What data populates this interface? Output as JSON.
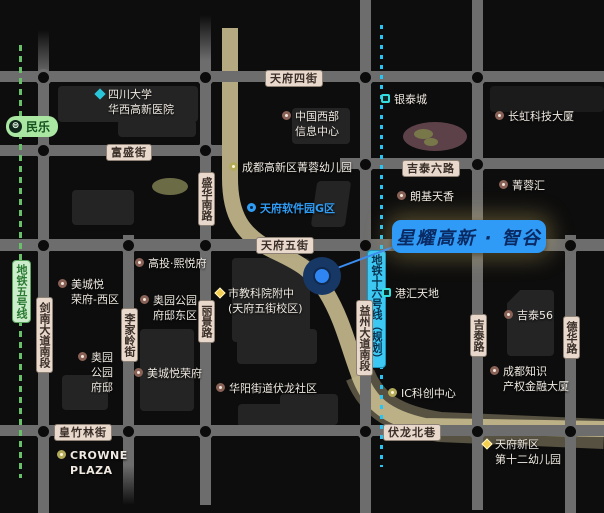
{
  "callout": {
    "text": "星耀高新 · 智谷"
  },
  "marker": {
    "name": "project-location"
  },
  "metro": {
    "line5": {
      "label": "地铁五号线",
      "station": "民乐",
      "color": "#69c06b"
    },
    "line16": {
      "label": "地铁十六号线（规划）",
      "color": "#29c4f2"
    }
  },
  "roads": {
    "h": [
      "天府四街",
      "富盛街",
      "吉泰六路",
      "天府五街",
      "皇竹林街",
      "伏龙北巷"
    ],
    "v": [
      "剑南大道南段",
      "李家岭街",
      "盛华南路",
      "丽景路",
      "益州大道南段",
      "吉泰路",
      "德华路"
    ]
  },
  "pois": [
    {
      "text": "四川大学\n华西高新医院",
      "icon": "hospital"
    },
    {
      "text": "中国西部\n信息中心",
      "icon": "building"
    },
    {
      "text": "成都高新区菁蓉幼儿园",
      "icon": "kindergarten"
    },
    {
      "text": "银泰城",
      "icon": "mall"
    },
    {
      "text": "长虹科技大厦",
      "icon": "building"
    },
    {
      "text": "菁蓉汇",
      "icon": "building"
    },
    {
      "text": "朗基天香",
      "icon": "building"
    },
    {
      "text": "天府软件园G区",
      "icon": "tech-park"
    },
    {
      "text": "港汇天地",
      "icon": "mall"
    },
    {
      "text": "吉泰56",
      "icon": "building"
    },
    {
      "text": "成都知识\n产权金融大厦",
      "icon": "building"
    },
    {
      "text": "IC科创中心",
      "icon": "kindergarten"
    },
    {
      "text": "华阳街道伏龙社区",
      "icon": "building"
    },
    {
      "text": "美城悦荣府",
      "icon": "building"
    },
    {
      "text": "美城悦\n荣府-西区",
      "icon": "building"
    },
    {
      "text": "高投·熙悦府",
      "icon": "building"
    },
    {
      "text": "奥园公园\n府邸东区",
      "icon": "building"
    },
    {
      "text": "奥园\n公园\n府邸",
      "icon": "building"
    },
    {
      "text": "市教科院附中\n(天府五街校区)",
      "icon": "school"
    },
    {
      "text": "CROWNE\nPLAZA",
      "icon": "hotel"
    },
    {
      "text": "天府新区\n第十二幼儿园",
      "icon": "school"
    }
  ],
  "colors": {
    "background": "#0d0d0d",
    "road": "#6d6d6d",
    "main_road": "#c6ba8e",
    "callout_bg": "#2f9bf7",
    "callout_text": "#0a2a63",
    "metro5": "#69c06b",
    "metro16": "#29c4f2"
  }
}
